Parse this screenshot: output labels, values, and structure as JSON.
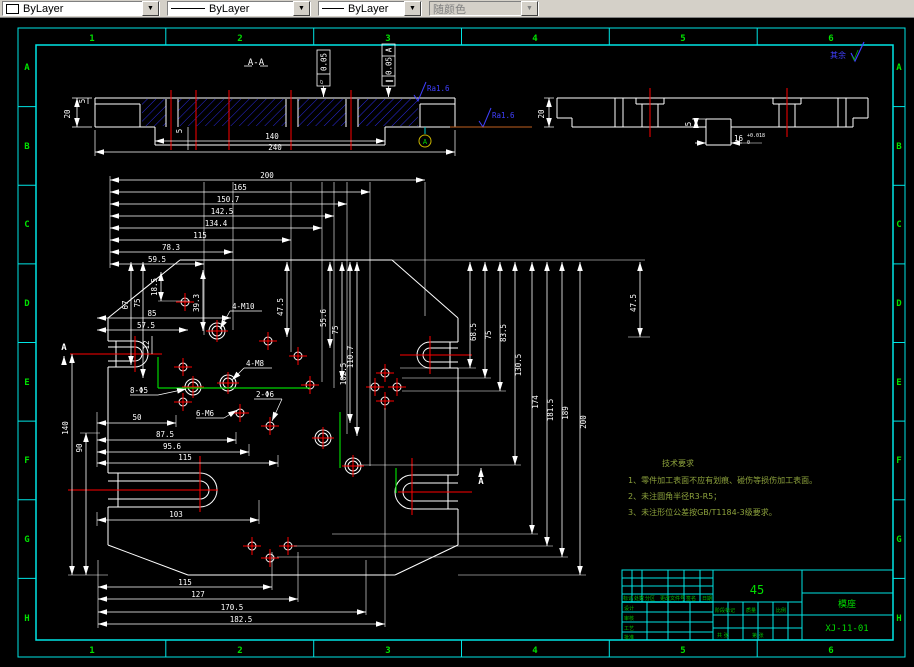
{
  "toolbar": {
    "color_combo": "ByLayer",
    "linetype_combo": "ByLayer",
    "lineweight_combo": "ByLayer",
    "plotstyle_combo": "随颜色"
  },
  "frame": {
    "cols": [
      "1",
      "2",
      "3",
      "4",
      "5",
      "6"
    ],
    "rows": [
      "A",
      "B",
      "C",
      "D",
      "E",
      "F",
      "G",
      "H"
    ]
  },
  "sectionAA": {
    "title": "A-A",
    "dim_5_top": "5",
    "dim_20": "20",
    "dim_5_inner": "5",
    "dim_140": "140",
    "dim_240": "240",
    "fcf_flatness_sym": "▱",
    "fcf_flatness_val": "0.05",
    "fcf_parallel_sym": "∥",
    "fcf_parallel_val": "0.05",
    "fcf_parallel_datum": "A",
    "ra_top": "Ra1.6",
    "ra_bottom": "Ra1.6",
    "datum": "A"
  },
  "sectionB": {
    "dim_20": "20",
    "dim_5": "5",
    "dim_16": "16",
    "tol_upper": "+0.018",
    "tol_lower": "0",
    "surface_note": "其余"
  },
  "plan": {
    "top_dims": [
      "200",
      "165",
      "150.7",
      "142.5",
      "134.4",
      "115",
      "78.3",
      "59.5"
    ],
    "right_dims": [
      "68.5",
      "75",
      "83.5",
      "130.5",
      "174",
      "181.5",
      "189",
      "200"
    ],
    "left_dims": [
      "140",
      "90"
    ],
    "inner_dims": [
      "67",
      "75",
      "18.5",
      "39.3",
      "85",
      "57.5",
      "12",
      "47.5",
      "55.6",
      "75",
      "110.7",
      "102.5",
      "47.5"
    ],
    "bottom_left_dims": [
      "50",
      "87.5",
      "95.6",
      "115",
      "103"
    ],
    "bottom_dims": [
      "115",
      "127",
      "170.5",
      "182.5"
    ],
    "labels": [
      "4-M10",
      "4-M8",
      "2-Φ6",
      "8-Φ5",
      "6-M6"
    ],
    "section_arrow": "A"
  },
  "notes": {
    "title": "技术要求",
    "items": [
      "1、零件加工表面不应有划痕、碰伤等损伤加工表面。",
      "2、未注圆角半径R3-R5；",
      "3、未注形位公差按GB/T1184-3级要求。"
    ]
  },
  "title_block": {
    "material": "45",
    "part_name": "模座",
    "drawing_no": "XJ-11-01",
    "rev_labels": [
      "标记",
      "处数",
      "分区",
      "更改文件号",
      "签名",
      "日期"
    ],
    "role_labels": [
      "设计",
      "审核",
      "工艺",
      "批准"
    ],
    "misc_labels": [
      "阶段标记",
      "质量",
      "比例",
      "共 张",
      "第 张"
    ]
  }
}
